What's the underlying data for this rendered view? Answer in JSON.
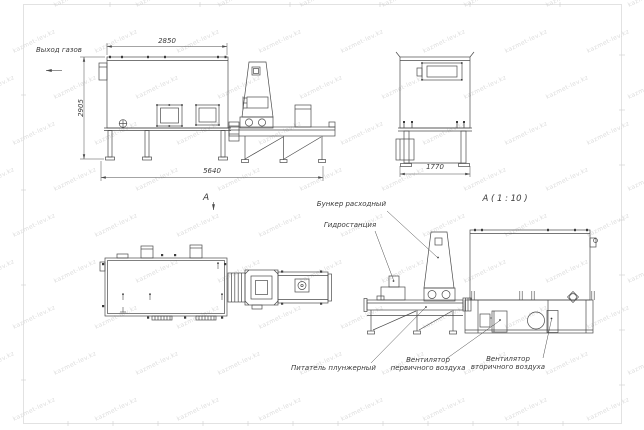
{
  "watermark": {
    "text": "kazmet-lev.kz"
  },
  "labels": {
    "gas_outlet": "Выход газов",
    "view_a": "А",
    "detail_title": "А ( 1 : 10 )",
    "feed_hopper": "Бункер расходный",
    "hydrostation": "Гидростанция",
    "plunger_feeder": "Питатель плунжерный",
    "primary_fan_1": "Вентилятор",
    "primary_fan_2": "первичного воздуха",
    "secondary_fan_1": "Вентилятор",
    "secondary_fan_2": "вторичного воздуха"
  },
  "dimensions": {
    "side_top": "2850",
    "side_height": "2905",
    "side_length": "5640",
    "front_width": "1770"
  },
  "colors": {
    "line": "#4a4a4a",
    "dim_text": "#3a3a3a",
    "frame": "#cfcfcf",
    "watermark": "#dcdcdc"
  }
}
